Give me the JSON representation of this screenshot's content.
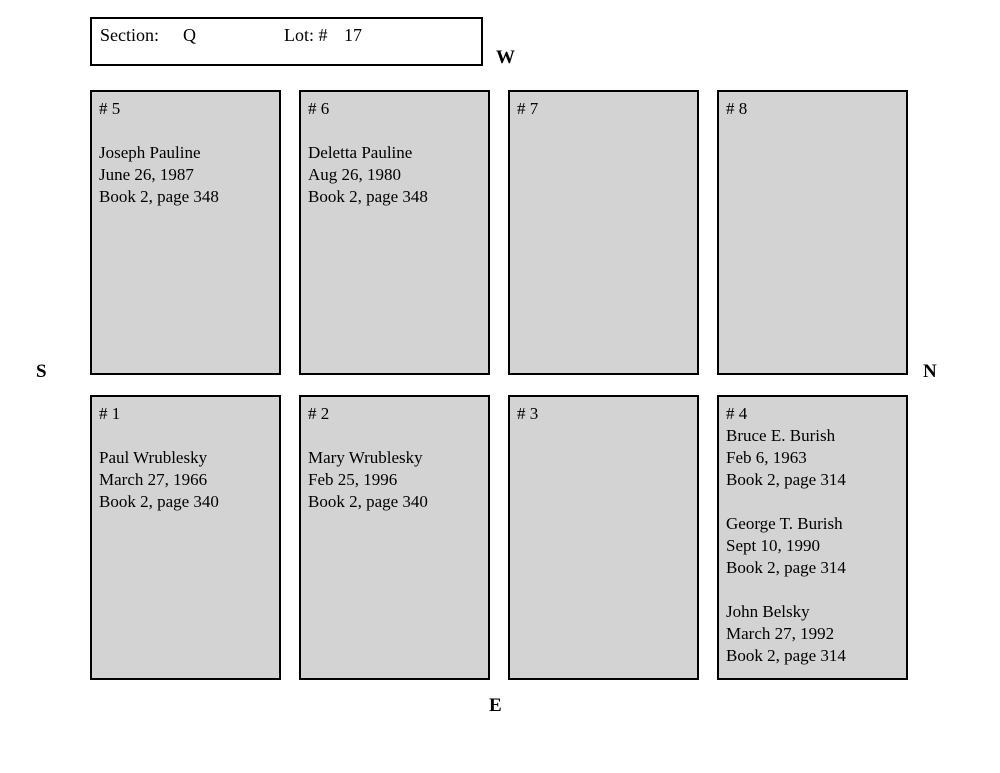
{
  "header": {
    "section_label": "Section:",
    "section_value": "Q",
    "lot_label": "Lot: #",
    "lot_value": "17"
  },
  "compass": {
    "west": "W",
    "south": "S",
    "north": "N",
    "east": "E"
  },
  "colors": {
    "plot_fill": "#d3d3d3",
    "border": "#000000",
    "background": "#ffffff"
  },
  "plots": [
    {
      "number": "# 1",
      "records": [
        {
          "name": "Paul Wrublesky",
          "date": "March 27, 1966",
          "book": "Book 2, page 340"
        }
      ]
    },
    {
      "number": "# 2",
      "records": [
        {
          "name": "Mary Wrublesky",
          "date": "Feb 25, 1996",
          "book": "Book 2, page 340"
        }
      ]
    },
    {
      "number": "# 3",
      "records": []
    },
    {
      "number": "# 4",
      "records": [
        {
          "name": "Bruce E. Burish",
          "date": "Feb 6, 1963",
          "book": "Book 2, page 314"
        },
        {
          "name": "George T. Burish",
          "date": "Sept 10, 1990",
          "book": "Book 2, page 314"
        },
        {
          "name": "John Belsky",
          "date": "March 27, 1992",
          "book": "Book 2, page 314"
        }
      ]
    },
    {
      "number": "# 5",
      "records": [
        {
          "name": "Joseph Pauline",
          "date": "June 26, 1987",
          "book": "Book 2, page 348"
        }
      ]
    },
    {
      "number": "# 6",
      "records": [
        {
          "name": "Deletta Pauline",
          "date": "Aug 26, 1980",
          "book": "Book 2, page 348"
        }
      ]
    },
    {
      "number": "# 7",
      "records": []
    },
    {
      "number": "# 8",
      "records": []
    }
  ]
}
